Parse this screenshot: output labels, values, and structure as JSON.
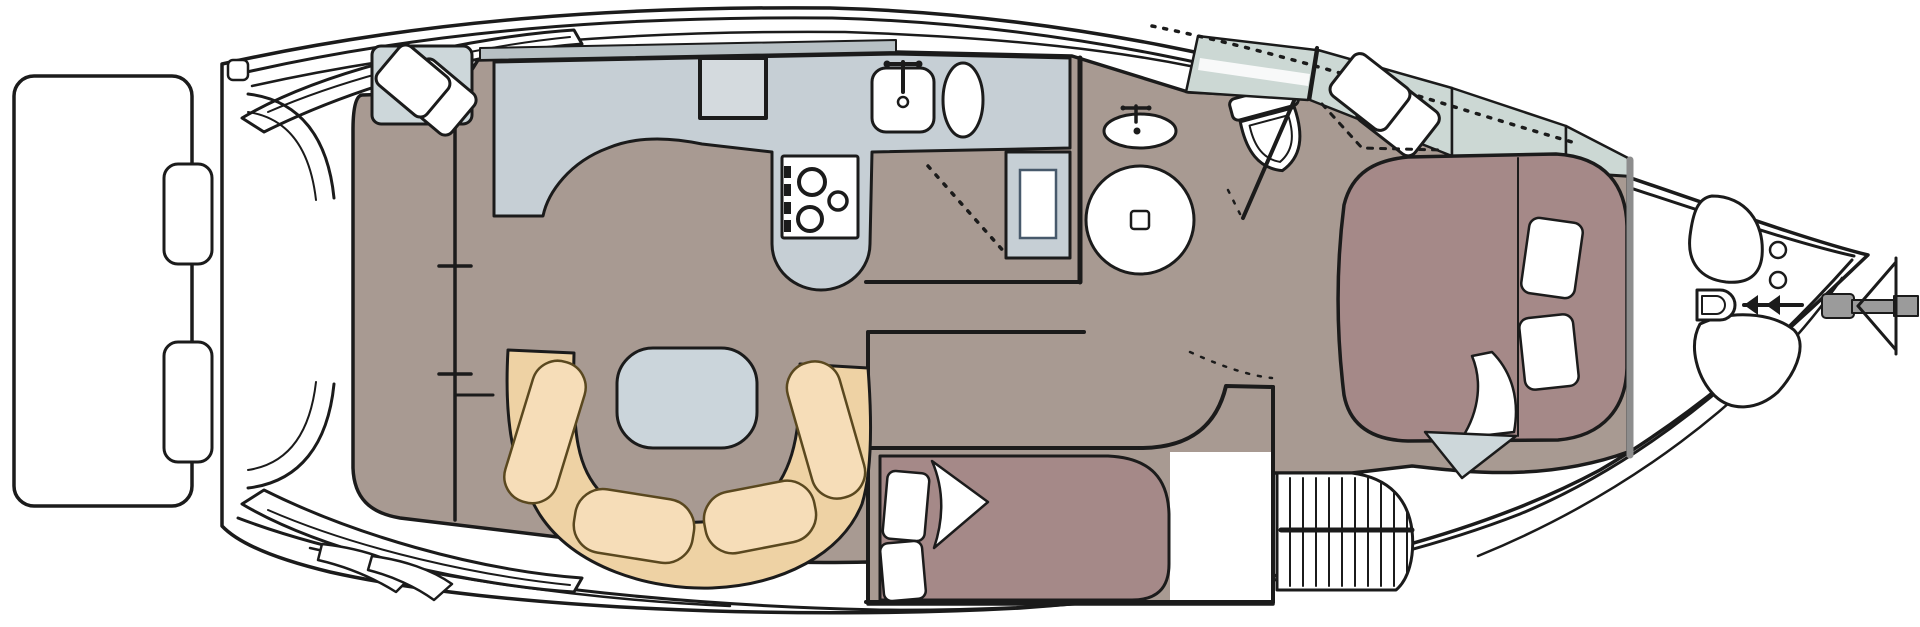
{
  "title": "Motor yacht interior deck plan, top view with bow to the right",
  "canvas": {
    "width": 1920,
    "height": 627
  },
  "colors": {
    "background": "#ffffff",
    "line": "#1b1b1b",
    "hull": "#ffffff",
    "floor": "#a89a92",
    "bed": "#a58988",
    "pillow": "#ffffff",
    "settee": "#eed2a4",
    "cushion": "#f6ddb8",
    "cushion_line": "#5a481f",
    "table": "#cbd5db",
    "counter": "#c6cfd5",
    "panel": "#d4dade",
    "pad": "#cdd7da",
    "glass": "#ccd8d4",
    "window": "#b7c0c4",
    "fixture": "#ffffff",
    "bulkhead": "#8d8d8d",
    "metal": "#9b9b9b"
  },
  "areas": {
    "boat": "motor yacht deck plan",
    "swim_platform": "swim platform",
    "cockpit": "aft cockpit",
    "salon": "salon",
    "helm": "lower helm station",
    "dinette": "U-shaped dinette",
    "galley": "galley",
    "head": "head with shower and toilet",
    "mid_cabin": "aft guest cabin",
    "forward_cabin": "forward stateroom",
    "foredeck": "foredeck",
    "bow": "bow with windlass and anchor"
  },
  "fixtures": {
    "helm_seat": "helm seat",
    "table": "dinette table",
    "settee": "U-shaped settee",
    "stove": "three-burner stove",
    "locker": "galley locker",
    "sink": "galley sink",
    "basin": "galley basin",
    "washbasin": "head washbasin",
    "shower": "round shower pan",
    "toilet": "marine toilet",
    "mid_berth": "double berth",
    "island_berth": "island double berth",
    "companion_seat": "companion seat",
    "hanging_locker": "hanging locker",
    "steps": "companionway steps",
    "deck_hatch": "deck hatch",
    "windlass": "anchor windlass",
    "cleat": "bow cleat",
    "anchor": "anchor on bow roller",
    "windshield": "wrap-around windshield",
    "transom_steps": "transom steps",
    "stern_stairs": "boarding steps"
  }
}
